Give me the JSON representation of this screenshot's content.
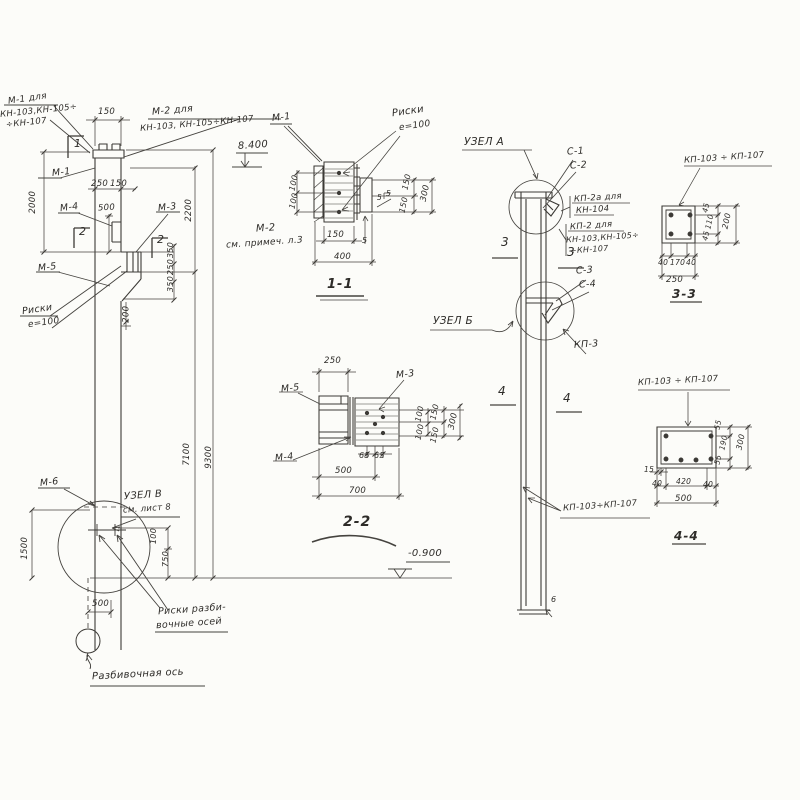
{
  "page": {
    "background": "#fcfcf9",
    "ink": "#3c3a36"
  },
  "drawing": {
    "kind": "structural column detail sheet",
    "section_titles": [
      "1-1",
      "2-2",
      "3-3",
      "4-4"
    ],
    "node_titles": [
      "УЗЕЛ А",
      "УЗЕЛ Б",
      "УЗЕЛ В"
    ],
    "levels": {
      "top": "8.400",
      "bottom": "-0.900"
    }
  },
  "labels": [
    {
      "name": "label-m1-variant",
      "text": "М-1 для",
      "x": 8,
      "y": 95,
      "rot": -8,
      "size": 9
    },
    {
      "name": "label-m1-variant-models",
      "text": "КН-103,КН-105÷",
      "x": 0,
      "y": 107,
      "rot": -6,
      "size": 8.5
    },
    {
      "name": "label-m1-variant-models2",
      "text": "÷КН-107",
      "x": 6,
      "y": 119,
      "rot": -6,
      "size": 8.5
    },
    {
      "name": "label-m2-variant",
      "text": "М-2 для",
      "x": 152,
      "y": 106,
      "rot": -5,
      "size": 9.5
    },
    {
      "name": "label-m2-variant-models",
      "text": "КН-103, КН-105÷КН-107",
      "x": 140,
      "y": 120,
      "rot": -5,
      "size": 8.5
    },
    {
      "name": "label-m1-ref",
      "text": "М-1",
      "x": 272,
      "y": 113,
      "rot": -6,
      "size": 9.5
    },
    {
      "name": "level-8400",
      "text": "8.400",
      "x": 238,
      "y": 141,
      "rot": -4,
      "size": 10
    },
    {
      "name": "dim-150-top",
      "text": "150",
      "x": 98,
      "y": 108,
      "size": 8.5
    },
    {
      "name": "section-mark-1",
      "text": "1",
      "x": 74,
      "y": 138,
      "size": 11
    },
    {
      "name": "label-m1",
      "text": "М-1",
      "x": 52,
      "y": 168,
      "rot": -6,
      "size": 9.5
    },
    {
      "name": "dim-2000",
      "text": "2000",
      "x": 22,
      "y": 198,
      "rot": -90,
      "size": 8.5
    },
    {
      "name": "dim-250-elev",
      "text": "250",
      "x": 91,
      "y": 180,
      "size": 8.5
    },
    {
      "name": "dim-150-elev",
      "text": "150",
      "x": 110,
      "y": 180,
      "size": 8.5
    },
    {
      "name": "label-m4",
      "text": "М-4",
      "x": 60,
      "y": 203,
      "rot": -8,
      "size": 9.5
    },
    {
      "name": "dim-500-elev",
      "text": "500",
      "x": 98,
      "y": 204,
      "rot": -3,
      "size": 8.5
    },
    {
      "name": "section-mark-2-left",
      "text": "2",
      "x": 79,
      "y": 226,
      "size": 11
    },
    {
      "name": "section-mark-2-right",
      "text": "2",
      "x": 157,
      "y": 234,
      "size": 11
    },
    {
      "name": "label-m3-elev",
      "text": "М-3",
      "x": 158,
      "y": 203,
      "rot": -6,
      "size": 9.5
    },
    {
      "name": "label-m5-elev",
      "text": "М-5",
      "x": 38,
      "y": 263,
      "rot": -6,
      "size": 9.5
    },
    {
      "name": "label-riski-elev",
      "text": "Риски",
      "x": 22,
      "y": 305,
      "rot": -8,
      "size": 9.5
    },
    {
      "name": "label-riski-e100-elev",
      "text": "е=100",
      "x": 28,
      "y": 319,
      "rot": -8,
      "size": 9
    },
    {
      "name": "dim-350-a",
      "text": "350",
      "x": 163,
      "y": 246,
      "rot": -90,
      "size": 8
    },
    {
      "name": "dim-250-b",
      "text": "250",
      "x": 163,
      "y": 263,
      "rot": -90,
      "size": 8
    },
    {
      "name": "dim-350-b",
      "text": "350",
      "x": 163,
      "y": 280,
      "rot": -90,
      "size": 8
    },
    {
      "name": "dim-200",
      "text": "200",
      "x": 118,
      "y": 310,
      "rot": -90,
      "size": 8.5
    },
    {
      "name": "dim-2200",
      "text": "2200",
      "x": 178,
      "y": 206,
      "rot": -90,
      "size": 8.5
    },
    {
      "name": "dim-7100",
      "text": "7100",
      "x": 176,
      "y": 450,
      "rot": -90,
      "size": 8.5
    },
    {
      "name": "dim-9300",
      "text": "9300",
      "x": 198,
      "y": 453,
      "rot": -90,
      "size": 8.5
    },
    {
      "name": "label-m2-note",
      "text": "М-2",
      "x": 256,
      "y": 224,
      "rot": -4,
      "size": 10
    },
    {
      "name": "label-m2-note2",
      "text": "см. примеч. л.3",
      "x": 226,
      "y": 239,
      "rot": -4,
      "size": 9
    },
    {
      "name": "label-m6",
      "text": "М-6",
      "x": 40,
      "y": 478,
      "rot": -6,
      "size": 9.5
    },
    {
      "name": "label-uzel-v",
      "text": "УЗЕЛ В",
      "x": 124,
      "y": 491,
      "rot": -4,
      "size": 10
    },
    {
      "name": "label-uzel-v-sheet",
      "text": "см. лист 8",
      "x": 123,
      "y": 505,
      "rot": -4,
      "size": 8.5
    },
    {
      "name": "dim-1500",
      "text": "1500",
      "x": 14,
      "y": 544,
      "rot": -90,
      "size": 8.5
    },
    {
      "name": "dim-100-uzel",
      "text": "100",
      "x": 146,
      "y": 532,
      "rot": -90,
      "size": 8
    },
    {
      "name": "dim-750",
      "text": "750",
      "x": 158,
      "y": 555,
      "rot": -90,
      "size": 8
    },
    {
      "name": "level-minus-0900",
      "text": "-0.900",
      "x": 408,
      "y": 549,
      "size": 10
    },
    {
      "name": "dim-500-bottom",
      "text": "500",
      "x": 92,
      "y": 600,
      "size": 8.5
    },
    {
      "name": "label-riski-razbiv-1",
      "text": "Риски разби-",
      "x": 158,
      "y": 605,
      "rot": -4,
      "size": 9.5
    },
    {
      "name": "label-riski-razbiv-2",
      "text": "вочные осей",
      "x": 156,
      "y": 619,
      "rot": -4,
      "size": 9.5
    },
    {
      "name": "label-razbiv-axis",
      "text": "Разбивочная ось",
      "x": 92,
      "y": 670,
      "rot": -3,
      "size": 10
    },
    {
      "name": "label-riski-11",
      "text": "Риски",
      "x": 392,
      "y": 107,
      "rot": -8,
      "size": 10
    },
    {
      "name": "label-riski-e100-11",
      "text": "е=100",
      "x": 399,
      "y": 122,
      "rot": -8,
      "size": 9
    },
    {
      "name": "dim-100-11a",
      "text": "100",
      "x": 286,
      "y": 179,
      "rot": -78,
      "size": 8
    },
    {
      "name": "dim-100-11b",
      "text": "100",
      "x": 286,
      "y": 197,
      "rot": -78,
      "size": 8
    },
    {
      "name": "dim-150-11",
      "text": "150",
      "x": 327,
      "y": 231,
      "size": 8.5
    },
    {
      "name": "dim-400-11",
      "text": "400",
      "x": 334,
      "y": 253,
      "size": 8.5
    },
    {
      "name": "dim-5-11",
      "text": "5",
      "x": 362,
      "y": 237,
      "size": 8
    },
    {
      "name": "weld-5a",
      "text": "5",
      "x": 377,
      "y": 194,
      "size": 7.5
    },
    {
      "name": "weld-5b",
      "text": "5",
      "x": 386,
      "y": 190,
      "size": 7.5
    },
    {
      "name": "dim-150-11r1",
      "text": "150",
      "x": 399,
      "y": 178,
      "rot": -78,
      "size": 8
    },
    {
      "name": "dim-150-11r2",
      "text": "150",
      "x": 396,
      "y": 201,
      "rot": -78,
      "size": 8
    },
    {
      "name": "dim-300-11",
      "text": "300",
      "x": 417,
      "y": 189,
      "rot": -78,
      "size": 8.5
    },
    {
      "name": "title-section-1-1",
      "text": "1-1",
      "x": 327,
      "y": 278,
      "size": 13,
      "title": true
    },
    {
      "name": "dim-250-22",
      "text": "250",
      "x": 324,
      "y": 357,
      "size": 8.5
    },
    {
      "name": "label-m3-22",
      "text": "М-3",
      "x": 396,
      "y": 370,
      "rot": -6,
      "size": 9.5
    },
    {
      "name": "label-m5-22",
      "text": "М-5",
      "x": 281,
      "y": 384,
      "rot": -6,
      "size": 9.5
    },
    {
      "name": "label-m4-22",
      "text": "М-4",
      "x": 275,
      "y": 453,
      "rot": -6,
      "size": 9.5
    },
    {
      "name": "dim-100-22a",
      "text": "100",
      "x": 412,
      "y": 410,
      "rot": -78,
      "size": 8
    },
    {
      "name": "dim-100-22b",
      "text": "100",
      "x": 412,
      "y": 428,
      "rot": -78,
      "size": 8
    },
    {
      "name": "dim-150-22a",
      "text": "150",
      "x": 427,
      "y": 408,
      "rot": -78,
      "size": 8
    },
    {
      "name": "dim-150-22b",
      "text": "150",
      "x": 427,
      "y": 431,
      "rot": -78,
      "size": 8
    },
    {
      "name": "dim-300-22",
      "text": "300",
      "x": 445,
      "y": 417,
      "rot": -78,
      "size": 8.5
    },
    {
      "name": "dim-65-a",
      "text": "65",
      "x": 359,
      "y": 452,
      "size": 8
    },
    {
      "name": "dim-65-b",
      "text": "65",
      "x": 374,
      "y": 452,
      "size": 8
    },
    {
      "name": "dim-500-22",
      "text": "500",
      "x": 335,
      "y": 467,
      "size": 8.5
    },
    {
      "name": "dim-700-22",
      "text": "700",
      "x": 349,
      "y": 487,
      "size": 8.5
    },
    {
      "name": "title-section-2-2",
      "text": "2-2",
      "x": 343,
      "y": 515,
      "size": 14,
      "title": true
    },
    {
      "name": "label-uzel-a",
      "text": "УЗЕЛ А",
      "x": 464,
      "y": 137,
      "size": 10.5
    },
    {
      "name": "label-c1",
      "text": "С-1",
      "x": 567,
      "y": 147,
      "rot": -4,
      "size": 9.5
    },
    {
      "name": "label-c2",
      "text": "С-2",
      "x": 570,
      "y": 161,
      "rot": -4,
      "size": 9.5
    },
    {
      "name": "label-kp2a",
      "text": "КП-2а для",
      "x": 574,
      "y": 194,
      "rot": -4,
      "size": 8.5
    },
    {
      "name": "label-kp2a-model",
      "text": "КН-104",
      "x": 576,
      "y": 206,
      "rot": -4,
      "size": 8.5
    },
    {
      "name": "label-kp2",
      "text": "КП-2 для",
      "x": 570,
      "y": 222,
      "rot": -4,
      "size": 8.5
    },
    {
      "name": "label-kp2-models",
      "text": "КН-103,КН-105÷",
      "x": 566,
      "y": 234,
      "rot": -4,
      "size": 8
    },
    {
      "name": "label-kp2-models2",
      "text": "÷КН-107",
      "x": 570,
      "y": 246,
      "rot": -4,
      "size": 8
    },
    {
      "name": "section-mark-3-left",
      "text": "3",
      "x": 501,
      "y": 236,
      "size": 12
    },
    {
      "name": "section-mark-3-right",
      "text": "3",
      "x": 567,
      "y": 246,
      "size": 12
    },
    {
      "name": "label-c3",
      "text": "С-3",
      "x": 576,
      "y": 266,
      "rot": -4,
      "size": 9.5
    },
    {
      "name": "label-c4",
      "text": "С-4",
      "x": 579,
      "y": 280,
      "rot": -4,
      "size": 9.5
    },
    {
      "name": "label-uzel-b",
      "text": "УЗЕЛ Б",
      "x": 433,
      "y": 316,
      "size": 10.5
    },
    {
      "name": "label-kp3",
      "text": "КП-3",
      "x": 574,
      "y": 340,
      "rot": -4,
      "size": 9.5
    },
    {
      "name": "section-mark-4-left",
      "text": "4",
      "x": 498,
      "y": 385,
      "size": 12
    },
    {
      "name": "section-mark-4-right",
      "text": "4",
      "x": 563,
      "y": 392,
      "size": 12
    },
    {
      "name": "label-kp103-107-col",
      "text": "КП-103÷КП-107",
      "x": 563,
      "y": 502,
      "rot": -4,
      "size": 8.5
    },
    {
      "name": "dim-6-base",
      "text": "6",
      "x": 551,
      "y": 596,
      "size": 8
    },
    {
      "name": "label-kp103-107-33",
      "text": "КП-103 ÷ КП-107",
      "x": 684,
      "y": 154,
      "rot": -4,
      "size": 8.5
    },
    {
      "name": "dim-45-33a",
      "text": "45",
      "x": 701,
      "y": 204,
      "rot": -78,
      "size": 7.5
    },
    {
      "name": "dim-110-33",
      "text": "110",
      "x": 702,
      "y": 218,
      "rot": -78,
      "size": 7.5
    },
    {
      "name": "dim-45-33b",
      "text": "45",
      "x": 701,
      "y": 232,
      "rot": -78,
      "size": 7.5
    },
    {
      "name": "dim-200-33",
      "text": "200",
      "x": 719,
      "y": 217,
      "rot": -78,
      "size": 8
    },
    {
      "name": "dim-40-33a",
      "text": "40",
      "x": 658,
      "y": 259,
      "size": 7.5
    },
    {
      "name": "dim-170-33",
      "text": "170",
      "x": 670,
      "y": 259,
      "size": 7.5
    },
    {
      "name": "dim-40-33b",
      "text": "40",
      "x": 686,
      "y": 259,
      "size": 7.5
    },
    {
      "name": "dim-250-33",
      "text": "250",
      "x": 666,
      "y": 276,
      "size": 8.5
    },
    {
      "name": "title-section-3-3",
      "text": "3-3",
      "x": 672,
      "y": 288,
      "size": 12,
      "title": true
    },
    {
      "name": "label-kp103-107-44",
      "text": "КП-103 ÷ КП-107",
      "x": 638,
      "y": 377,
      "rot": -3,
      "size": 8.5
    },
    {
      "name": "dim-55-44a",
      "text": "55",
      "x": 713,
      "y": 421,
      "rot": -78,
      "size": 7.5
    },
    {
      "name": "dim-190-44",
      "text": "190",
      "x": 716,
      "y": 439,
      "rot": -78,
      "size": 7.5
    },
    {
      "name": "dim-55-44b",
      "text": "55",
      "x": 713,
      "y": 456,
      "rot": -78,
      "size": 7.5
    },
    {
      "name": "dim-300-44",
      "text": "300",
      "x": 733,
      "y": 438,
      "rot": -78,
      "size": 8
    },
    {
      "name": "dim-15-44",
      "text": "15",
      "x": 644,
      "y": 466,
      "size": 7.5
    },
    {
      "name": "dim-40-44a",
      "text": "40",
      "x": 652,
      "y": 480,
      "size": 7.5
    },
    {
      "name": "dim-420-44",
      "text": "420",
      "x": 676,
      "y": 478,
      "size": 7.5
    },
    {
      "name": "dim-40-44b",
      "text": "40",
      "x": 703,
      "y": 481,
      "size": 7.5
    },
    {
      "name": "dim-500-44",
      "text": "500",
      "x": 675,
      "y": 495,
      "size": 8.5
    },
    {
      "name": "title-section-4-4",
      "text": "4-4",
      "x": 674,
      "y": 530,
      "size": 12,
      "title": true
    }
  ]
}
